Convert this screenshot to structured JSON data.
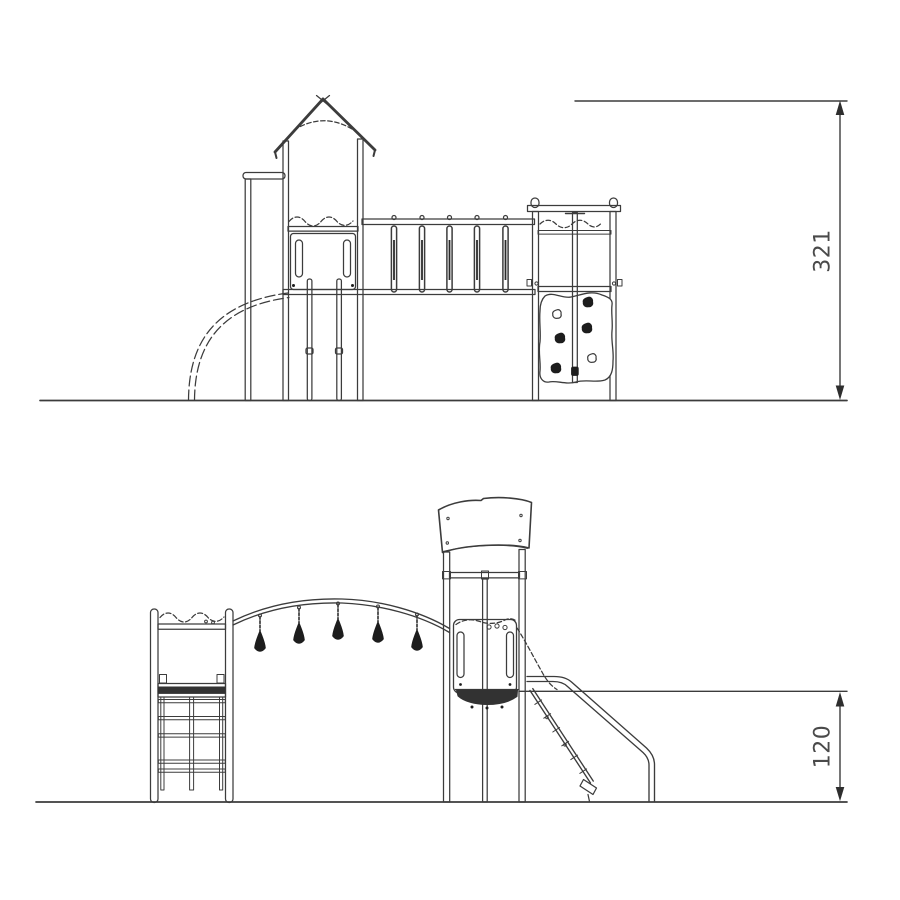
{
  "drawing": {
    "background_color": "#ffffff",
    "line_color": "#3c3c3c",
    "dark_fill_color": "#1d1d1d",
    "upper_view": {
      "height_dimension_label": "321"
    },
    "lower_view": {
      "height_dimension_label": "120"
    }
  }
}
